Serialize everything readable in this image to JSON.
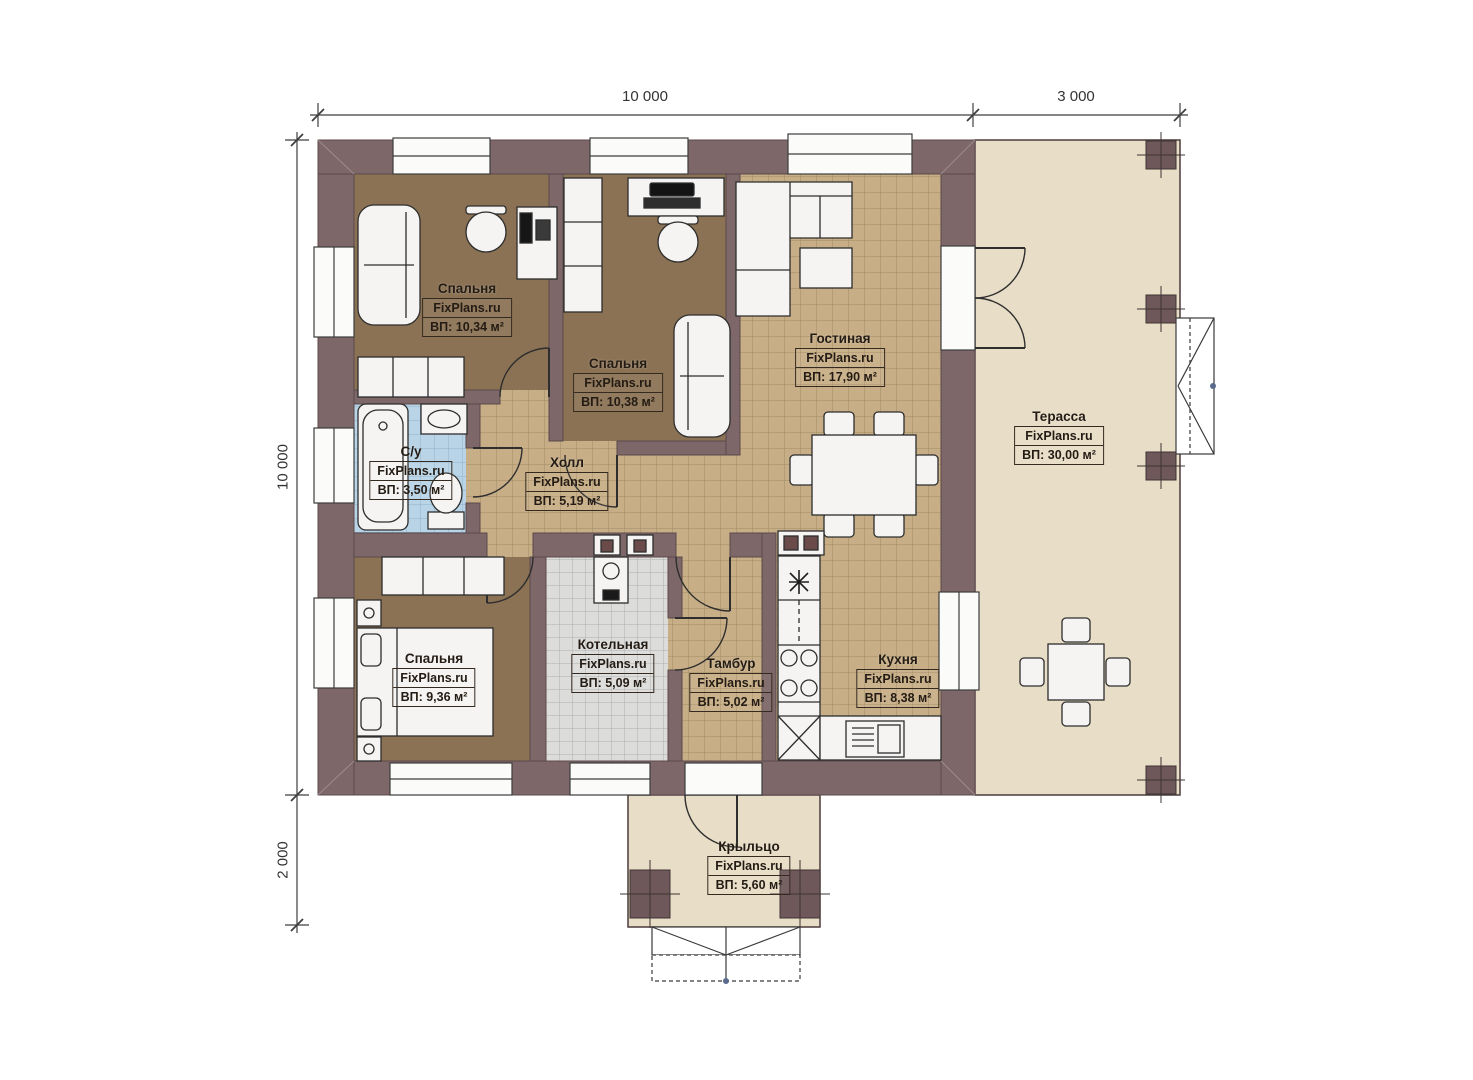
{
  "watermark": "FixPlans.ru",
  "dimensions": {
    "top": [
      {
        "label": "10 000"
      },
      {
        "label": "3 000"
      }
    ],
    "left": [
      {
        "label": "10 000"
      },
      {
        "label": "2 000"
      }
    ]
  },
  "rooms": [
    {
      "id": "bedroom-1",
      "name": "Спальня",
      "area": "ВП: 10,34 м²"
    },
    {
      "id": "bedroom-2",
      "name": "Спальня",
      "area": "ВП: 10,38 м²"
    },
    {
      "id": "living",
      "name": "Гостиная",
      "area": "ВП: 17,90 м²"
    },
    {
      "id": "terrace",
      "name": "Терасса",
      "area": "ВП: 30,00 м²"
    },
    {
      "id": "bathroom",
      "name": "С/у",
      "area": "ВП: 3,50 м²"
    },
    {
      "id": "hall",
      "name": "Холл",
      "area": "ВП: 5,19 м²"
    },
    {
      "id": "bedroom-3",
      "name": "Спальня",
      "area": "ВП: 9,36 м²"
    },
    {
      "id": "boiler",
      "name": "Котельная",
      "area": "ВП: 5,09 м²"
    },
    {
      "id": "tambour",
      "name": "Тамбур",
      "area": "ВП: 5,02 м²"
    },
    {
      "id": "kitchen",
      "name": "Кухня",
      "area": "ВП: 8,38 м²"
    },
    {
      "id": "porch",
      "name": "Крыльцо",
      "area": "ВП: 5,60 м²"
    }
  ],
  "colors": {
    "wall": "#7d6768",
    "tile_floor": "#c7ae86",
    "bedroom_floor": "#8b7254",
    "bathroom_floor": "#b9d4e6",
    "boiler_floor": "#dcdcda",
    "terrace_floor": "#e8ddc6",
    "furniture": "#f5f4f2"
  }
}
